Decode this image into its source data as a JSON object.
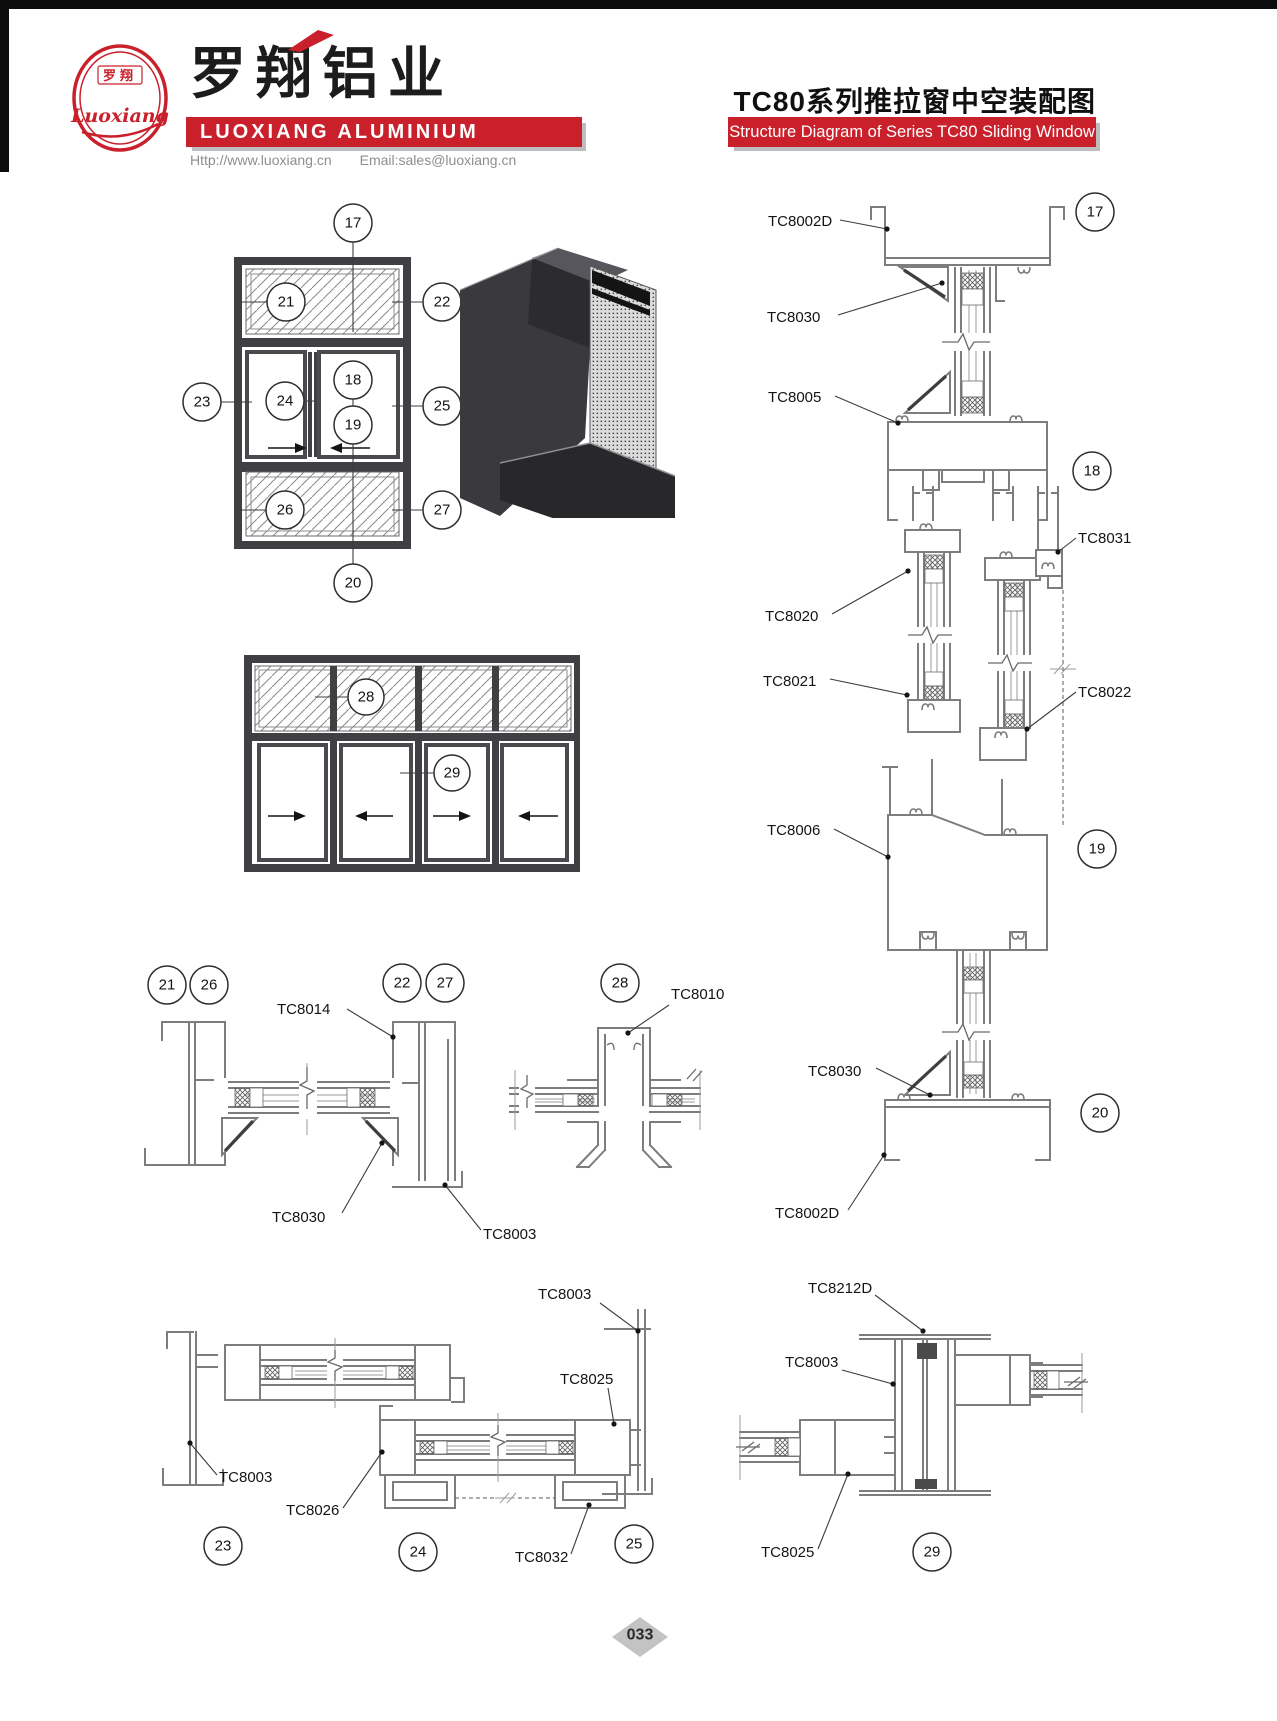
{
  "header": {
    "logo": {
      "top_text": "罗翔",
      "script_text": "Luoxiang"
    },
    "brand_cn": "罗翔铝业",
    "brand_en": "LUOXIANG ALUMINIUM",
    "website": "Http://www.luoxiang.cn",
    "email": "Email:sales@luoxiang.cn",
    "title_cn": "TC80系列推拉窗中空装配图",
    "title_en": "Structure Diagram of Series TC80 Sliding Window"
  },
  "colors": {
    "brand_red": "#c9202b",
    "profile_gray": "#7d7d7d",
    "frame_dark": "#3f3f44",
    "diamond_gray": "#c3c3c3"
  },
  "footer": {
    "page_number": "033"
  },
  "diagrams": {
    "elevation_main": {
      "callouts": [
        "17",
        "21",
        "22",
        "23",
        "24",
        "18",
        "19",
        "25",
        "26",
        "27",
        "20"
      ]
    },
    "elevation_wide": {
      "callouts": [
        "28",
        "29"
      ]
    },
    "section_vertical": {
      "labels": [
        "TC8002D",
        "TC8030",
        "TC8005",
        "TC8020",
        "TC8021",
        "TC8031",
        "TC8022",
        "TC8006",
        "TC8030",
        "TC8002D"
      ],
      "callouts": [
        "17",
        "18",
        "19",
        "20"
      ]
    },
    "detail_jamb": {
      "labels": [
        "TC8014",
        "TC8030",
        "TC8003"
      ],
      "callouts": [
        "21",
        "26",
        "22",
        "27"
      ]
    },
    "detail_mullion": {
      "labels": [
        "TC8010"
      ],
      "callouts": [
        "28"
      ]
    },
    "detail_interlock": {
      "labels": [
        "TC8003",
        "TC8025",
        "TC8003",
        "TC8026",
        "TC8032"
      ],
      "callouts": [
        "23",
        "24",
        "25"
      ]
    },
    "detail_meeting": {
      "labels": [
        "TC8212D",
        "TC8003",
        "TC8025"
      ],
      "callouts": [
        "29"
      ]
    }
  }
}
